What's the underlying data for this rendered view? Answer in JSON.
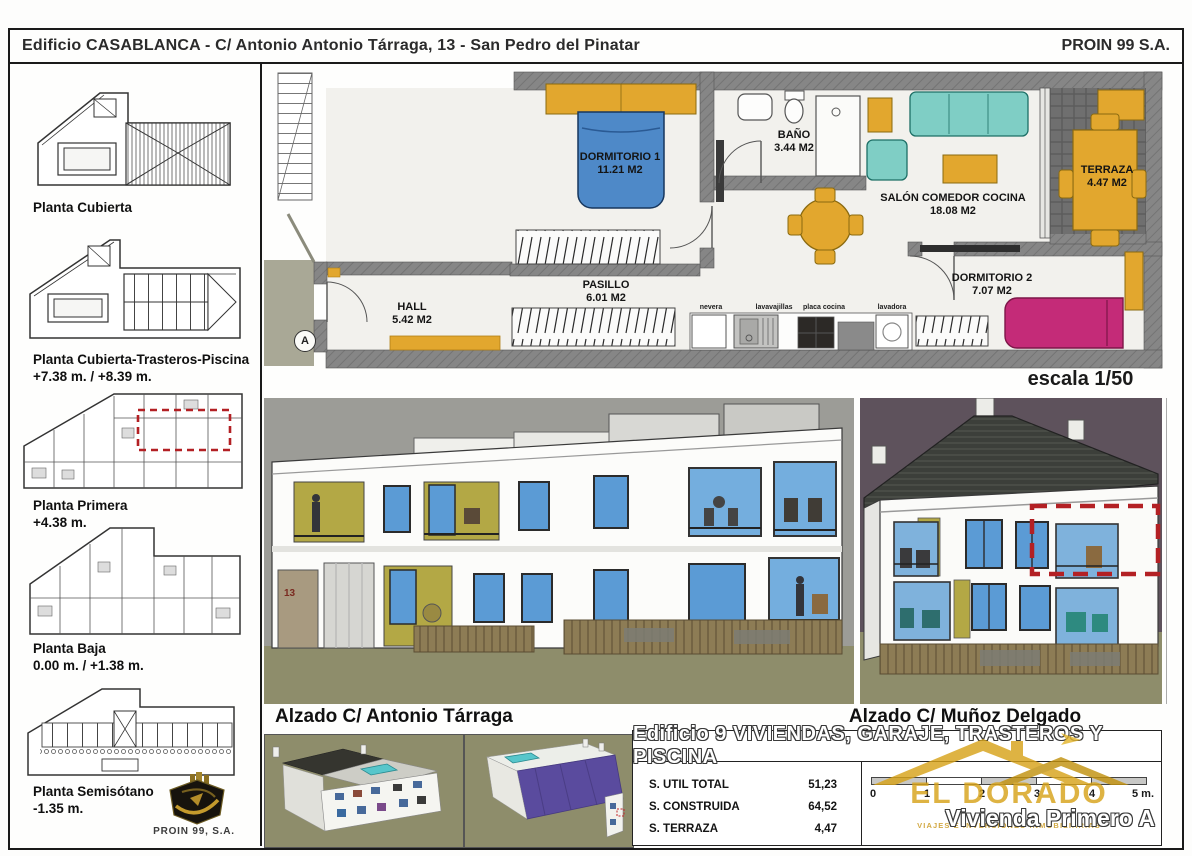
{
  "header": {
    "title": "Edificio CASABLANCA - C/ Antonio Antonio Tárraga, 13 - San Pedro del Pinatar",
    "company": "PROIN 99 S.A."
  },
  "sidebar": {
    "items": [
      {
        "label": "Planta Cubierta",
        "sublabel": ""
      },
      {
        "label": "Planta Cubierta-Trasteros-Piscina",
        "sublabel": "+7.38 m. / +8.39 m."
      },
      {
        "label": "Planta Primera",
        "sublabel": "+4.38 m."
      },
      {
        "label": "Planta Baja",
        "sublabel": "0.00 m. / +1.38 m."
      },
      {
        "label": "Planta Semisótano",
        "sublabel": "-1.35 m."
      }
    ],
    "logo_text": "PROIN 99, S.A."
  },
  "floorplan": {
    "rooms": [
      {
        "name": "DORMITORIO 1",
        "area": "11.21 M2"
      },
      {
        "name": "BAÑO",
        "area": "3.44 M2"
      },
      {
        "name": "SALÓN COMEDOR COCINA",
        "area": "18.08 M2"
      },
      {
        "name": "TERRAZA",
        "area": "4.47 M2"
      },
      {
        "name": "DORMITORIO 2",
        "area": "7.07 M2"
      },
      {
        "name": "PASILLO",
        "area": "6.01 M2"
      },
      {
        "name": "HALL",
        "area": "5.42 M2"
      }
    ],
    "appliances": [
      "nevera",
      "lavavajillas",
      "placa cocina",
      "lavadora"
    ],
    "section_marker": "A",
    "scale_note": "escala 1/50"
  },
  "elevations": {
    "left_label": "Alzado C/ Antonio Tárraga",
    "right_label": "Alzado C/ Muñoz Delgado",
    "door_number": "13"
  },
  "summary": {
    "title": "Edificio 9 VIVIENDAS, GARAJE, TRASTEROS Y PISCINA",
    "table": [
      {
        "label": "S. UTIL TOTAL",
        "value": "51,23"
      },
      {
        "label": "S. CONSTRUIDA",
        "value": "64,52"
      },
      {
        "label": "S. TERRAZA",
        "value": "4,47"
      }
    ],
    "scalebar": {
      "ticks": [
        "0",
        "1",
        "2",
        "3",
        "4",
        "5 m."
      ]
    },
    "unit_label": "Vivienda Primero A",
    "watermark": {
      "name": "EL DORADO",
      "tagline": "VIAJES E INVERSIONES INMOBILIARIAS"
    }
  },
  "colors": {
    "accent_yellow": "#E2A72E",
    "bed_blue": "#4E89C8",
    "sofa_teal": "#7FCEC5",
    "bed_pink": "#C42B78",
    "wall_gray": "#858585",
    "highlight_red": "#B32024",
    "brand_gold": "#D7A31A"
  }
}
